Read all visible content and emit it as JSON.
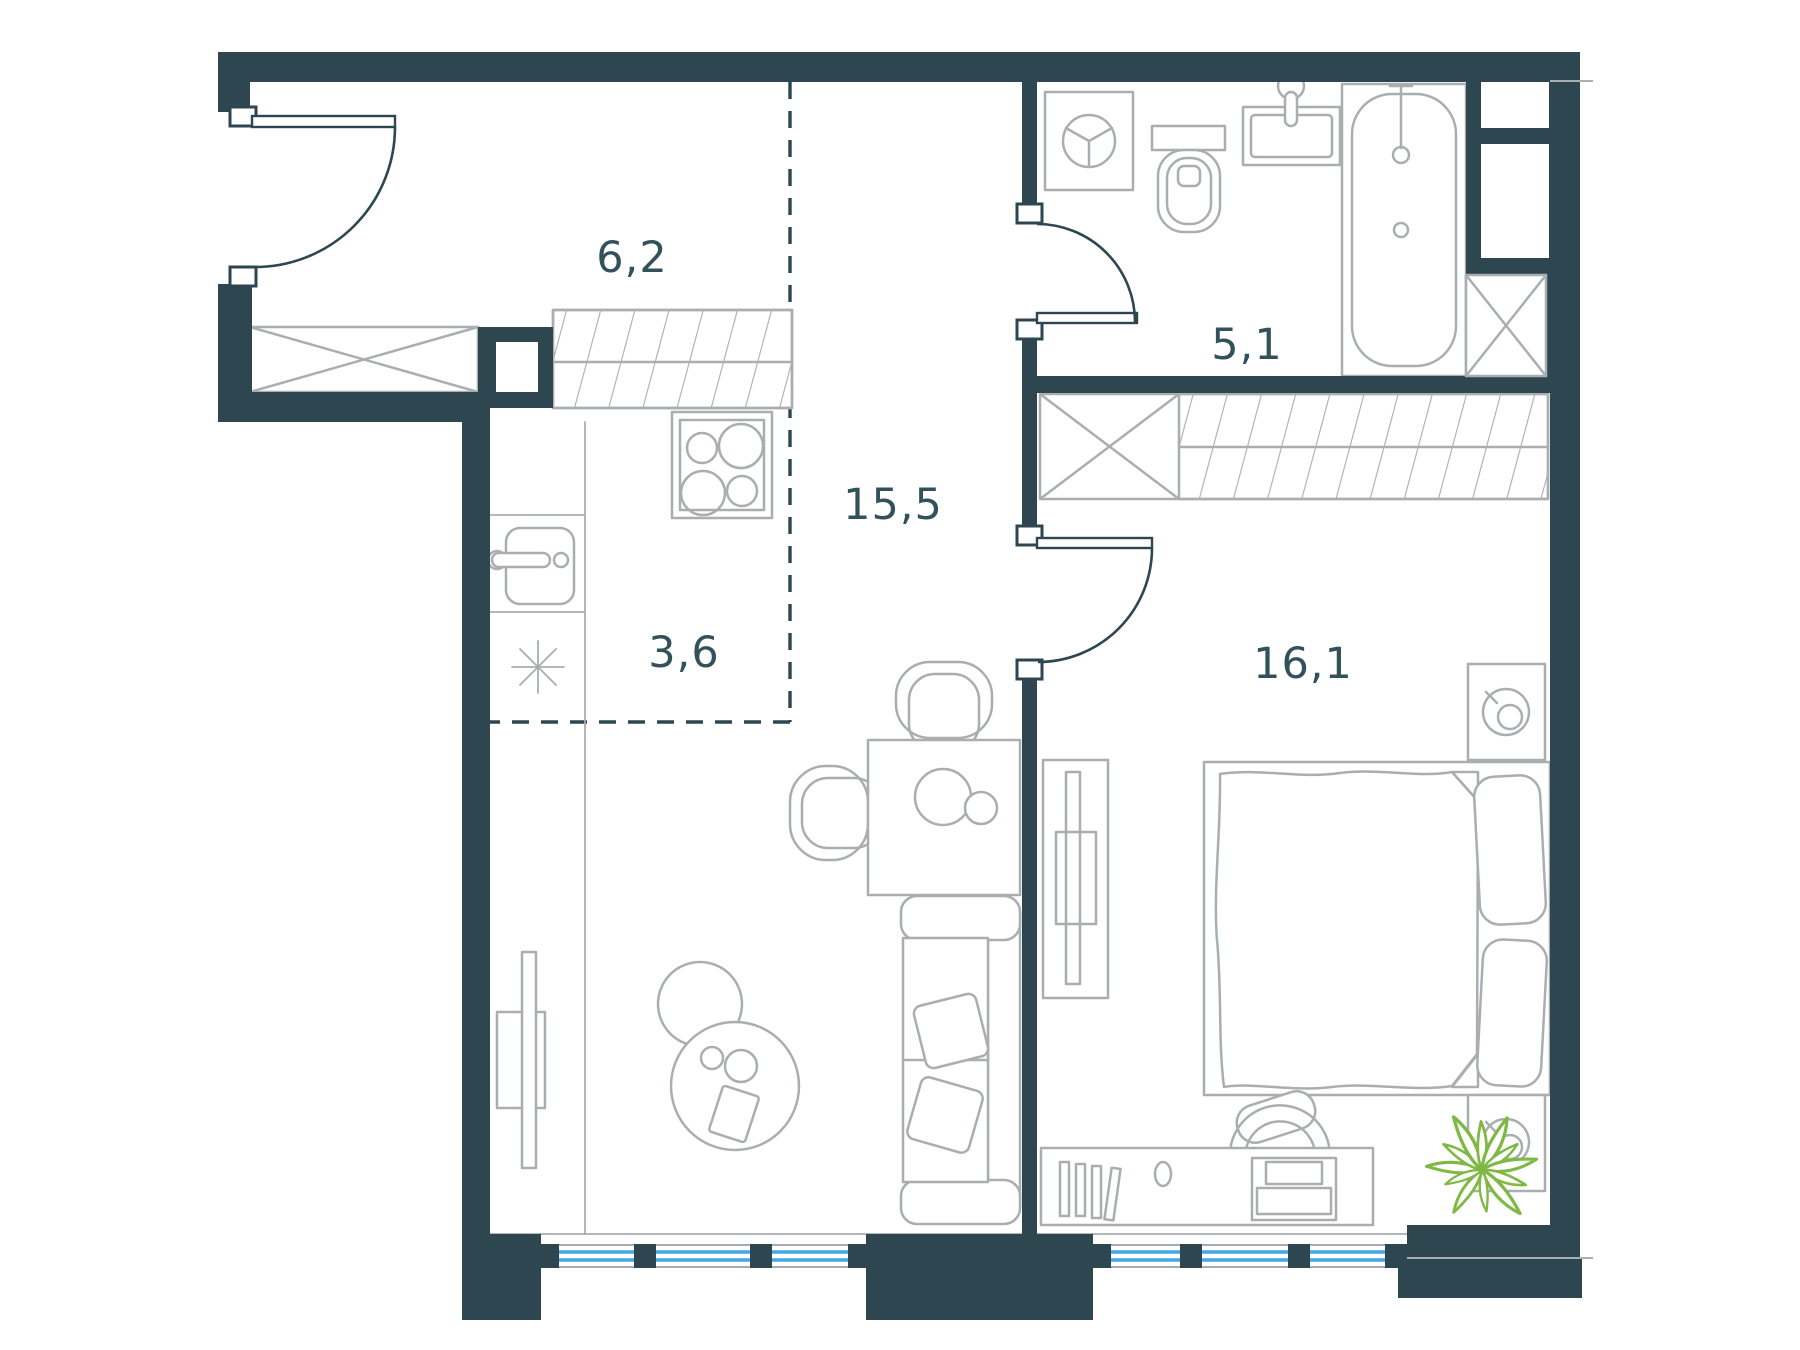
{
  "plan": {
    "type": "apartment-floor-plan",
    "rooms": {
      "hallway": {
        "id": "hallway",
        "area_label": "6,2"
      },
      "bathroom": {
        "id": "bathroom",
        "area_label": "5,1"
      },
      "living_kitchen": {
        "id": "living-kitchen",
        "area_label": "15,5"
      },
      "kitchen_zone": {
        "id": "kitchen-zone",
        "area_label": "3,6"
      },
      "bedroom": {
        "id": "bedroom",
        "area_label": "16,1"
      }
    }
  },
  "colors": {
    "wall": "#2E4650",
    "line": "#A9AEB0",
    "label": "#33515B",
    "window": "#42A7E5",
    "plant": "#7FB843",
    "bg": "#FFFFFF"
  }
}
